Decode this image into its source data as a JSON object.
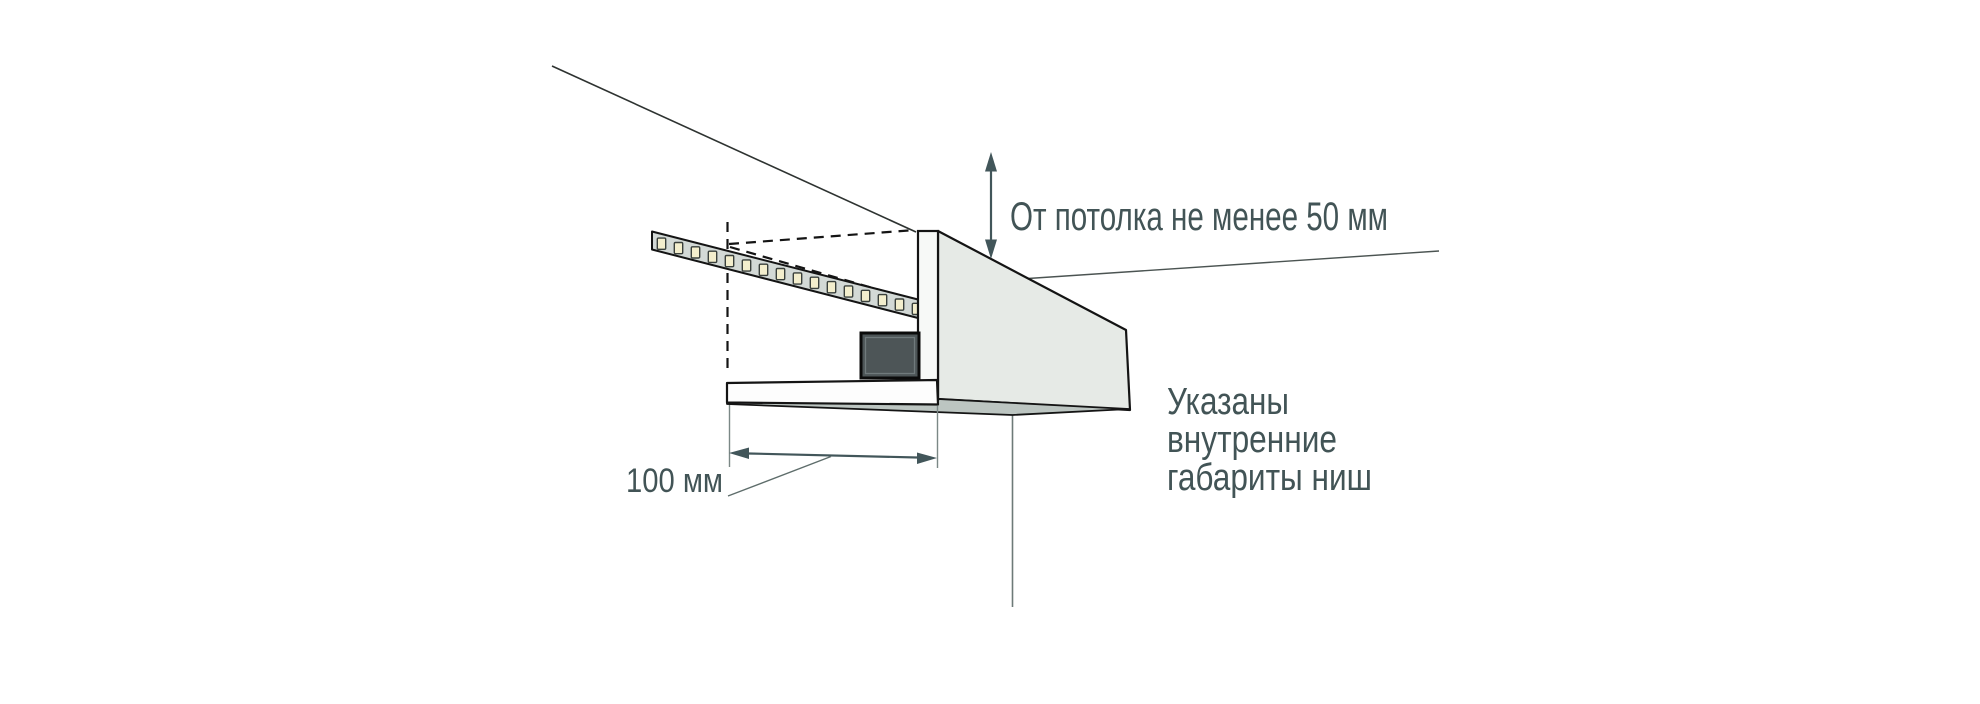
{
  "page": {
    "width": 1980,
    "height": 704,
    "background": "#ffffff",
    "description_domain": "technical installation diagram of LED strip niche"
  },
  "colors": {
    "text": "#425456",
    "dimension": "#42565a",
    "extension_line": "#7b8886",
    "leader_line": "#5e6d6b",
    "outline": "#141414",
    "ceiling_line": "#2e3331",
    "face": "#e6eae6",
    "underside": "#bcc5c1",
    "panel": "#f7f9f7",
    "shelf": "#fdfdfd",
    "strip": "#d3d9d6",
    "led": "#f3eecd",
    "led_border": "#3a403c",
    "driver": "#4d5557",
    "driver_bevel": "#707a7c"
  },
  "diagram": {
    "led_count": 16,
    "labels": {
      "ceiling_clearance": "От потолка не менее 50 мм",
      "niche_width": "100 мм",
      "note_lines": [
        "Указаны",
        "внутренние",
        "габариты ниш"
      ]
    }
  }
}
